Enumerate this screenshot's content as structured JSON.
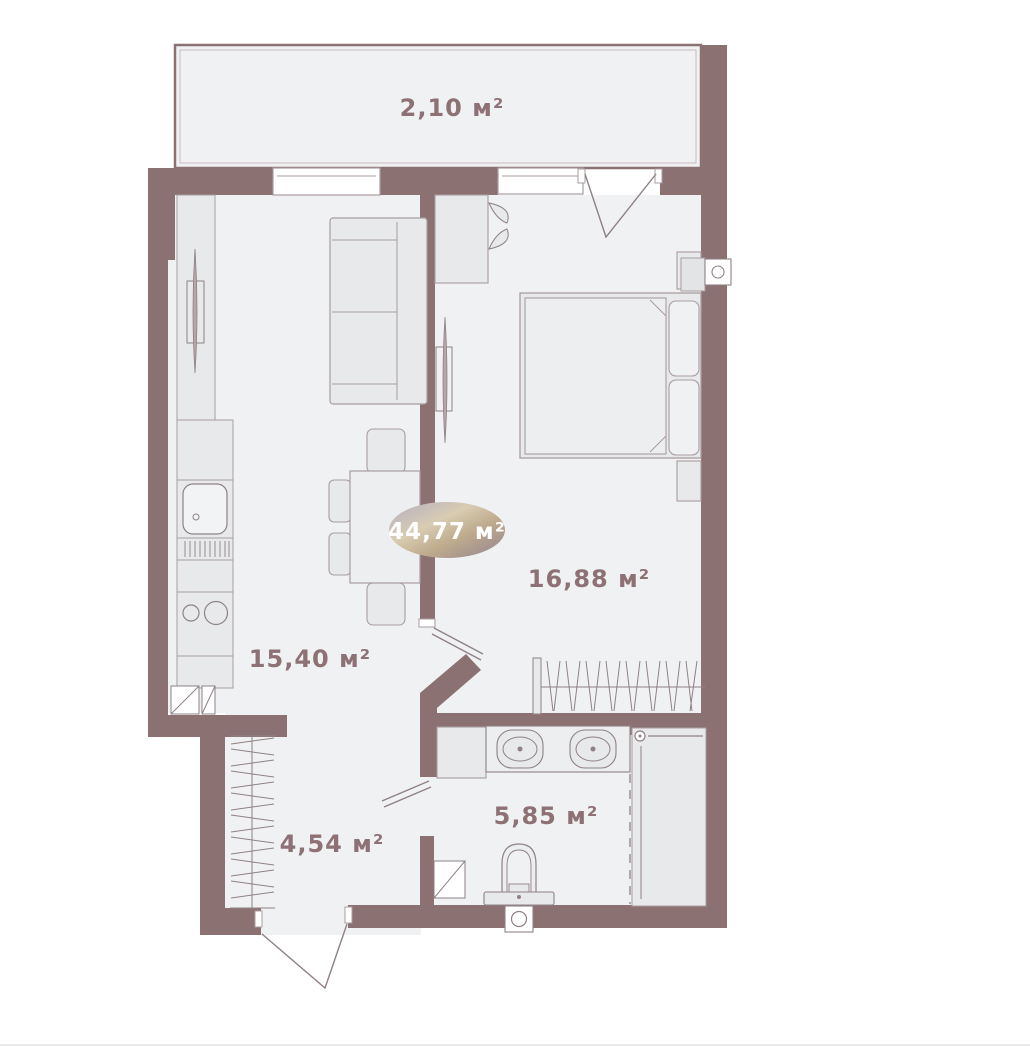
{
  "plan": {
    "kind": "apartment-floor-plan",
    "total_area": {
      "badge_label": "44,77 м²"
    },
    "rooms": [
      {
        "id": "balcony",
        "area_label": "2,10 м²"
      },
      {
        "id": "living-kitchen",
        "area_label": "15,40 м²"
      },
      {
        "id": "bedroom",
        "area_label": "16,88 м²"
      },
      {
        "id": "hallway",
        "area_label": "4,54 м²"
      },
      {
        "id": "bathroom",
        "area_label": "5,85 м²"
      }
    ],
    "colors": {
      "wall": "#8c7173",
      "floor": "#f0f1f2",
      "furniture_fill": "#e7e9ea",
      "furniture_stroke": "#a99d9f",
      "fixture_stroke": "#8f8185",
      "label_text": "#8d7174",
      "badge_text": "#ffffff",
      "badge_gradient_stops": [
        "#b5adc4",
        "#d8ccb2",
        "#bfab8d",
        "#92848e"
      ],
      "page_divider": "#e9eaeb"
    }
  }
}
